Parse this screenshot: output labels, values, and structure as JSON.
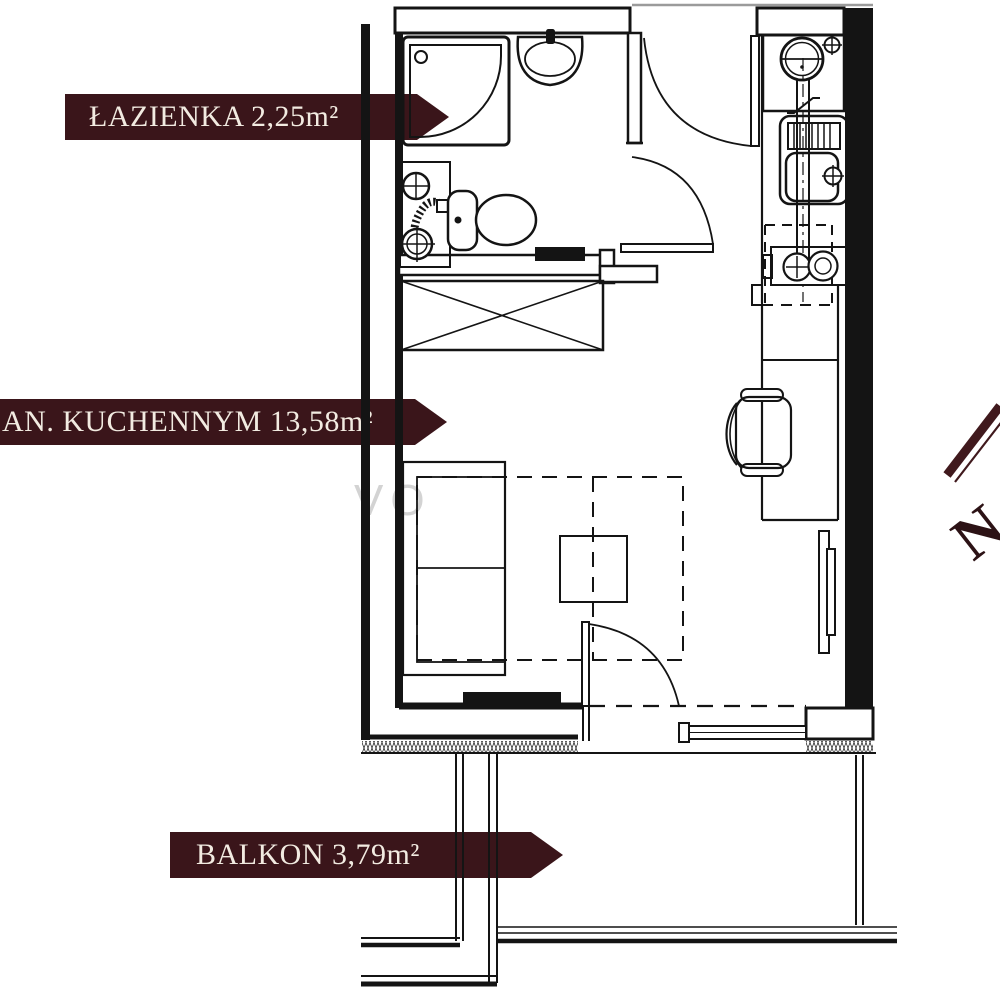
{
  "plan_labels": {
    "bathroom": "ŁAZIENKA 2,25m²",
    "living_room_kitchenette": "AN. KUCHENNYM 13,58m²",
    "balcony": "BALKON 3,79m²"
  },
  "rooms": [
    {
      "name": "ŁAZIENKA",
      "area": "2,25m²"
    },
    {
      "name": "AN. KUCHENNYM",
      "area": "13,58m²"
    },
    {
      "name": "BALKON",
      "area": "3,79m²"
    }
  ],
  "compass": {
    "letter": "N"
  },
  "watermark_fragment": "VO",
  "colors": {
    "banner_bg": "#3a151a",
    "banner_text": "#f2ebe1",
    "compass": "#40191d",
    "compass_letter": "#2c1215",
    "watermark": "#cfcfcf",
    "plan_line": "#141414",
    "background": "#ffffff"
  }
}
